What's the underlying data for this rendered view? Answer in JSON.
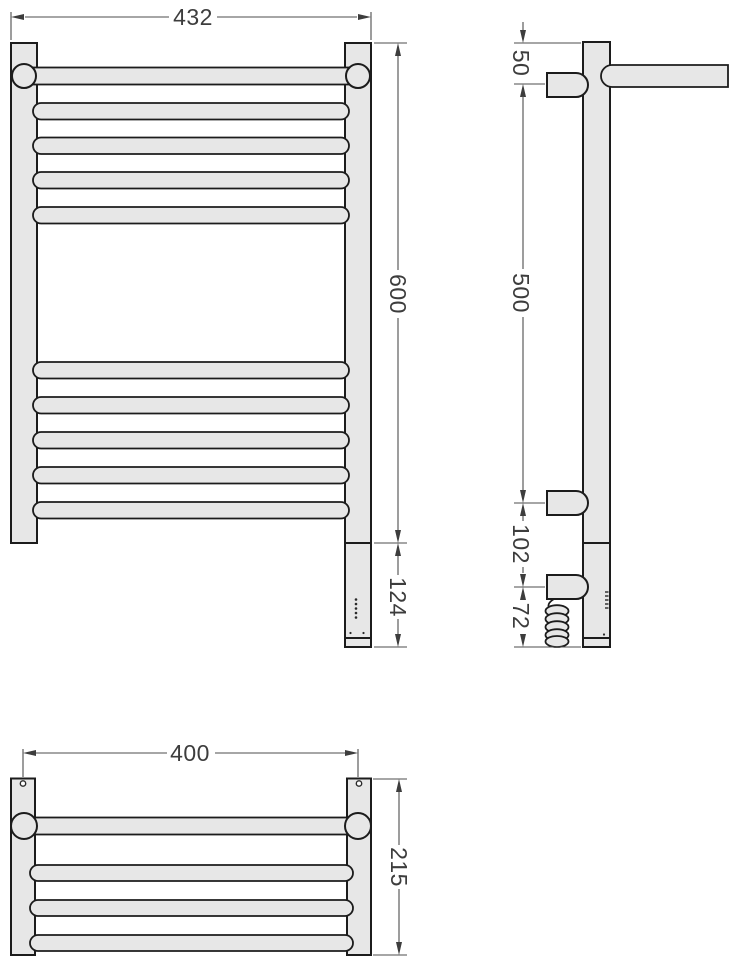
{
  "colors": {
    "background": "#ffffff",
    "part_fill": "#e7e7e7",
    "part_outline": "#1c1c1c",
    "dimension_line": "#4d4d4d",
    "dimension_text": "#3d3d3d"
  },
  "front_view": {
    "width": "432",
    "height": "600",
    "heater_length": "124"
  },
  "side_view": {
    "top_bracket_offset": "50",
    "bracket_spacing": "500",
    "element_offset": "102",
    "cable_length": "72"
  },
  "top_view": {
    "mounting_width": "400",
    "depth": "215"
  }
}
